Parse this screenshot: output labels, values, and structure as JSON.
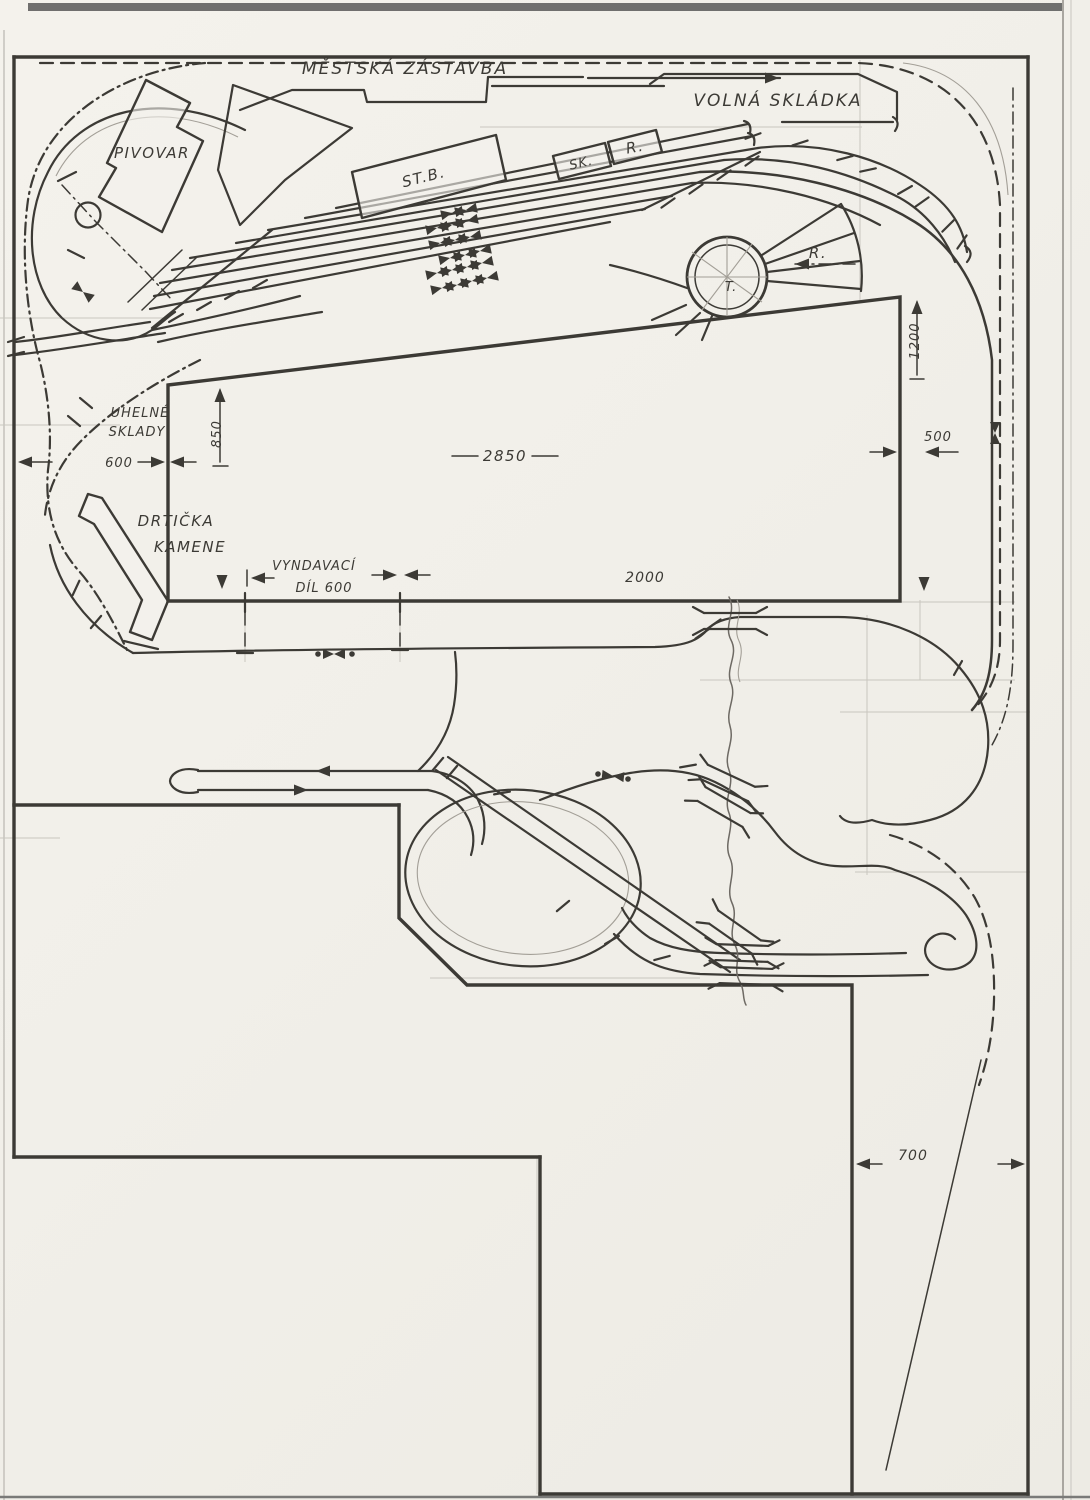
{
  "labels": {
    "mestska_zastavba": "MĚSTSKÁ ZÁSTAVBA",
    "volna_skladka": "VOLNÁ SKLÁDKA",
    "pivovar": "PIVOVAR",
    "st_b": "ST.B.",
    "sk": "SK.",
    "r_building": "R.",
    "r_depot": "R.",
    "t_turntable": "T.",
    "uhelne_line1": "UHELNÉ",
    "uhelne_line2": "SKLADY",
    "drticka_line1": "DRTIČKA",
    "drticka_line2": "KAMENE",
    "vyndavaci_line1": "VYNDAVACÍ",
    "vyndavaci_line2": "DÍL 600"
  },
  "dimensions": {
    "d850": "850",
    "d600": "600",
    "d2850": "2850",
    "d500": "500",
    "d1200": "1200",
    "d2000": "2000",
    "d700": "700"
  },
  "colors": {
    "paper": "#f2f0ea",
    "ink": "#3c3a35",
    "pencil": "#a39f97",
    "faint": "#c9c6bf",
    "scan": "#585858"
  }
}
